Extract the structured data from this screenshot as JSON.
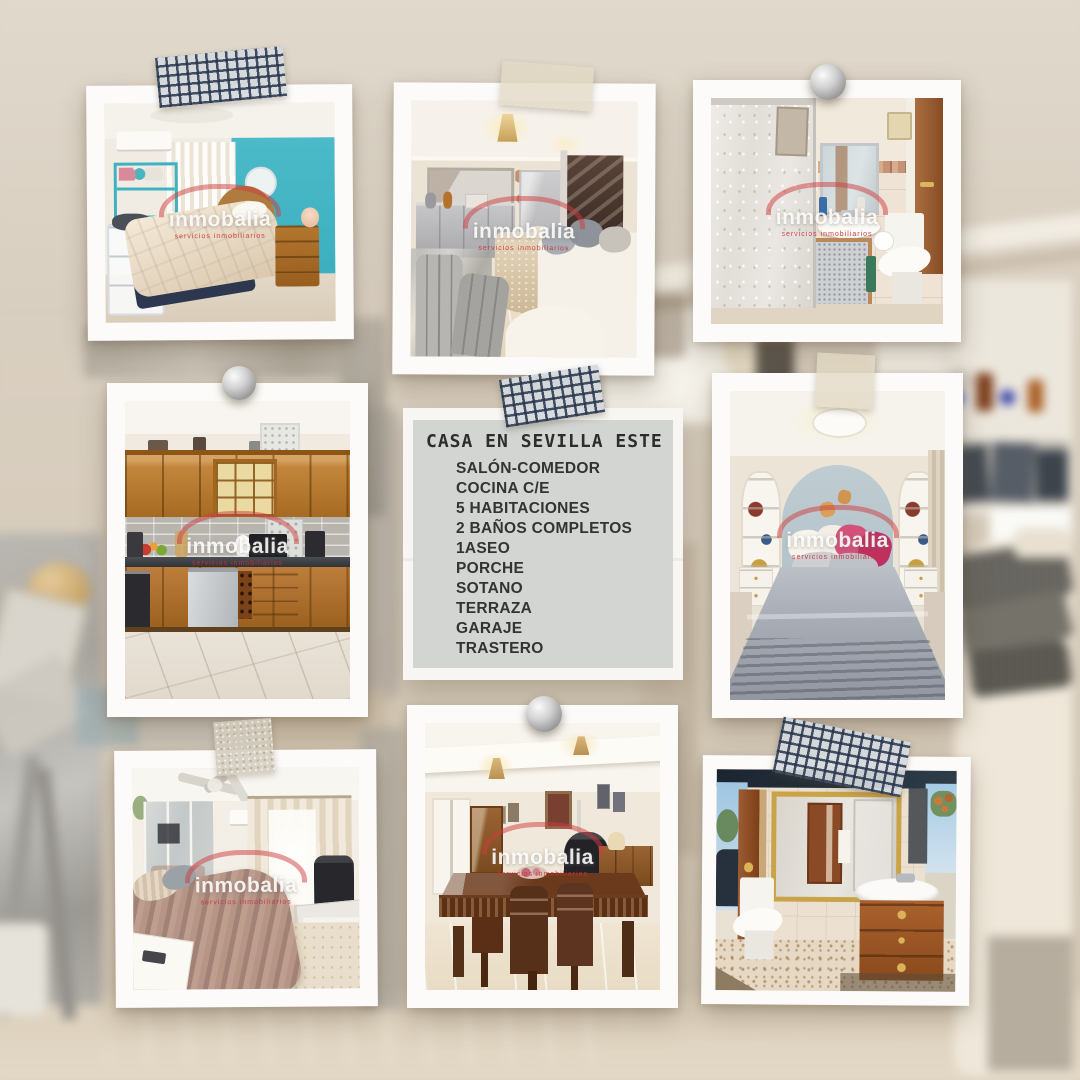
{
  "listing_card": {
    "title": "CASA EN SEVILLA ESTE",
    "features": [
      "SALÓN-COMEDOR",
      "COCINA C/E",
      "5 HABITACIONES",
      "2 BAÑOS COMPLETOS",
      "1ASEO",
      "PORCHE",
      "SOTANO",
      "TERRAZA",
      "GARAJE",
      "TRASTERO"
    ]
  },
  "watermark": {
    "brand": "inmobalia",
    "tagline": "servicios inmobiliarios"
  },
  "photos": [
    {
      "name": "teal-bedroom",
      "caption": "bedroom with turquoise accent wall"
    },
    {
      "name": "living-room",
      "caption": "living room with chandelier and white sofas"
    },
    {
      "name": "shower-bathroom",
      "caption": "bathroom with shower screen, basin and toilet"
    },
    {
      "name": "kitchen",
      "caption": "kitchen with oak cabinets and dishwasher"
    },
    {
      "name": "master-bedroom",
      "caption": "bedroom with arched alcove and grey bedspread"
    },
    {
      "name": "fan-bedroom",
      "caption": "bedroom with ceiling fan and mirrored wardrobe"
    },
    {
      "name": "dining-room",
      "caption": "dining room with carved wooden table"
    },
    {
      "name": "vanity-bathroom",
      "caption": "bathroom with gold mirror and wooden vanity"
    }
  ],
  "colors": {
    "teal_wall": "#45b8c6",
    "card_bg": "#d2d5d2",
    "tape_grid": "#2c3a4a",
    "tape_beige": "#e2d9c4",
    "accent_red": "#cd3c3e",
    "background_wall": "#d8cec0"
  }
}
